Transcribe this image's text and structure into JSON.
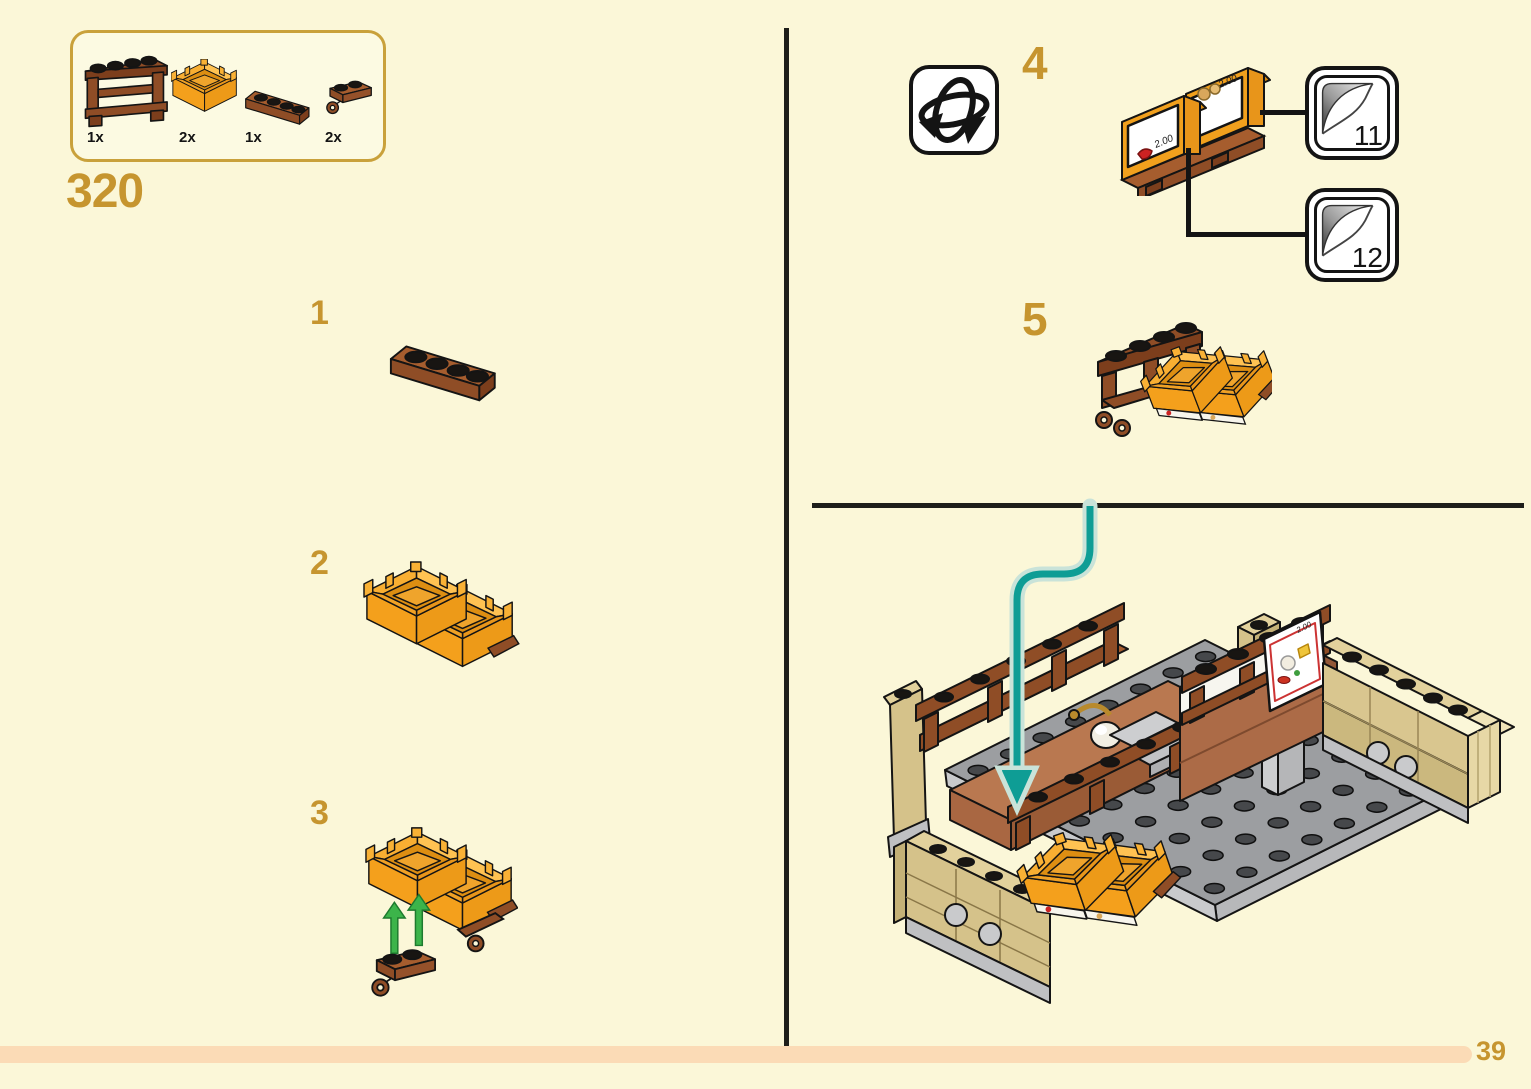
{
  "page": {
    "step_id": "320",
    "page_number": "39"
  },
  "parts_panel": {
    "items": [
      {
        "part": "fence-1x4x2-brown",
        "count": "1x"
      },
      {
        "part": "container-2x2-orange",
        "count": "2x"
      },
      {
        "part": "plate-1x4-brown",
        "count": "1x"
      },
      {
        "part": "plate-1x2-with-clip-brown",
        "count": "2x"
      }
    ]
  },
  "steps": [
    {
      "label": "1"
    },
    {
      "label": "2"
    },
    {
      "label": "3"
    },
    {
      "label": "4"
    },
    {
      "label": "5"
    }
  ],
  "callouts": {
    "sticker_11": "11",
    "sticker_12": "12"
  },
  "prices": {
    "sticker_left": "2.00",
    "sticker_right": "2.00",
    "poster": "2.00"
  },
  "icons": {
    "rotate": "rotate-model-icon",
    "sticker": "sticker-peel-icon"
  },
  "colors": {
    "background": "#FBF7D8",
    "accent_gold": "#C6952F",
    "panel_border": "#C9A13B",
    "divider": "#1E1E1A",
    "footer_bar": "#FBDBB6",
    "teal_arrow": "#0E9D95",
    "green_arrow": "#3CB44A",
    "brown": "#8F4D26",
    "orange": "#F5A41F",
    "tan": "#D5C28A",
    "gray_plate": "#9C9EA1"
  }
}
